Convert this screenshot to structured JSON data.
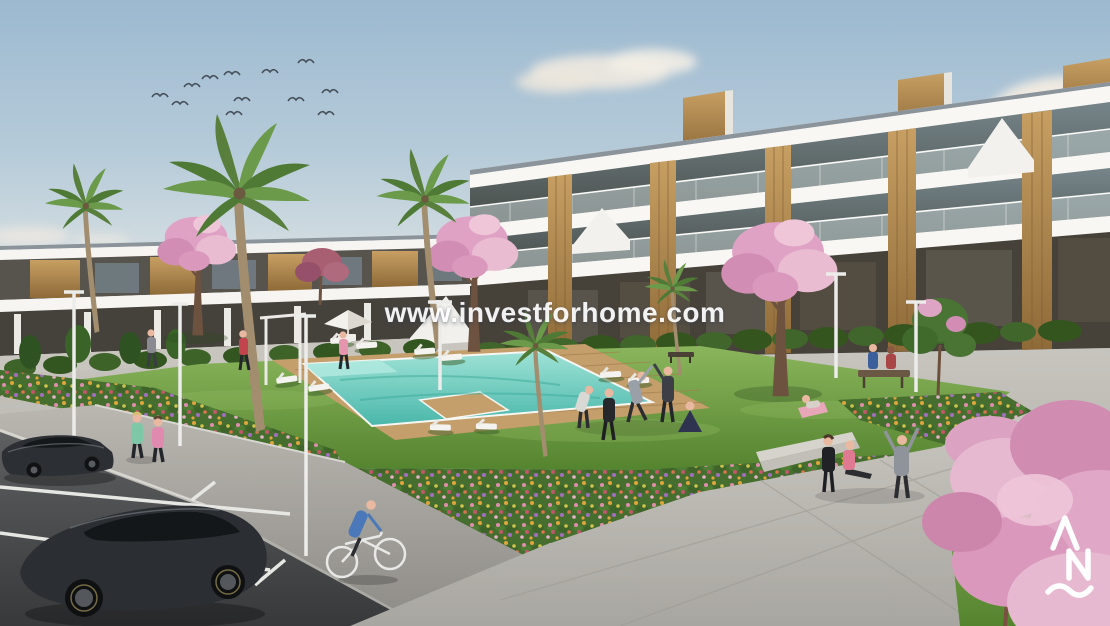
{
  "meta": {
    "type": "architectural-render",
    "subject": "New-build residential apartment complex with communal pool, landscaped gardens and parking"
  },
  "watermark": {
    "text": "www.investforhome.com",
    "color": "#ffffff"
  },
  "brand_logo": {
    "name": "stylized-AN-monogram-with-wave",
    "color": "#ffffff",
    "position": "bottom-right"
  },
  "palette": {
    "sky_top": "#9cb9d0",
    "sky_horizon": "#e0e3df",
    "cloud": "#f1ebe1",
    "building_white": "#f1f0ec",
    "building_slab": "#f8f7f4",
    "glass_dark": "#4d524e",
    "wood_accent": "#b98e52",
    "balustrade_glass": "#c2cfcf",
    "grass_light": "#86b258",
    "grass_dark": "#55842f",
    "hedge_green": "#3d6329",
    "pool_water_light": "#9fe2d6",
    "pool_water_deep": "#49b7aa",
    "deck_wood": "#c49e6b",
    "path_gray": "#b2afa9",
    "plaza_gray": "#c3c0ba",
    "asphalt": "#46484a",
    "flower_pink": "#e98fb4",
    "flower_orange": "#e8a93c",
    "flower_yellow": "#d8c94f",
    "flower_red": "#c9566f",
    "flower_purple": "#a86fc9",
    "blossom_pink": "#e3aac6",
    "car_body": "#2b2e32",
    "lamp_white": "#ececea"
  },
  "scene_elements": [
    "sky",
    "clouds",
    "bird-flock",
    "apartment-building-left",
    "apartment-building-right",
    "rooftop-wood-boxes",
    "palm-trees",
    "cherry-blossom-trees",
    "green-shrubs",
    "flower-beds",
    "lawn",
    "swimming-pool",
    "wooden-pool-deck",
    "sun-loungers",
    "parasol",
    "pool-shower-frame",
    "street-lamps",
    "benches",
    "pedestrian-path",
    "plaza",
    "steps",
    "parking-lot",
    "parking-lines",
    "car-sedan",
    "car-hatchback",
    "cyclist",
    "joggers",
    "pool-side-walkers",
    "yoga-group",
    "plaza-exercisers",
    "bench-couple",
    "watermark",
    "brand-logo"
  ]
}
